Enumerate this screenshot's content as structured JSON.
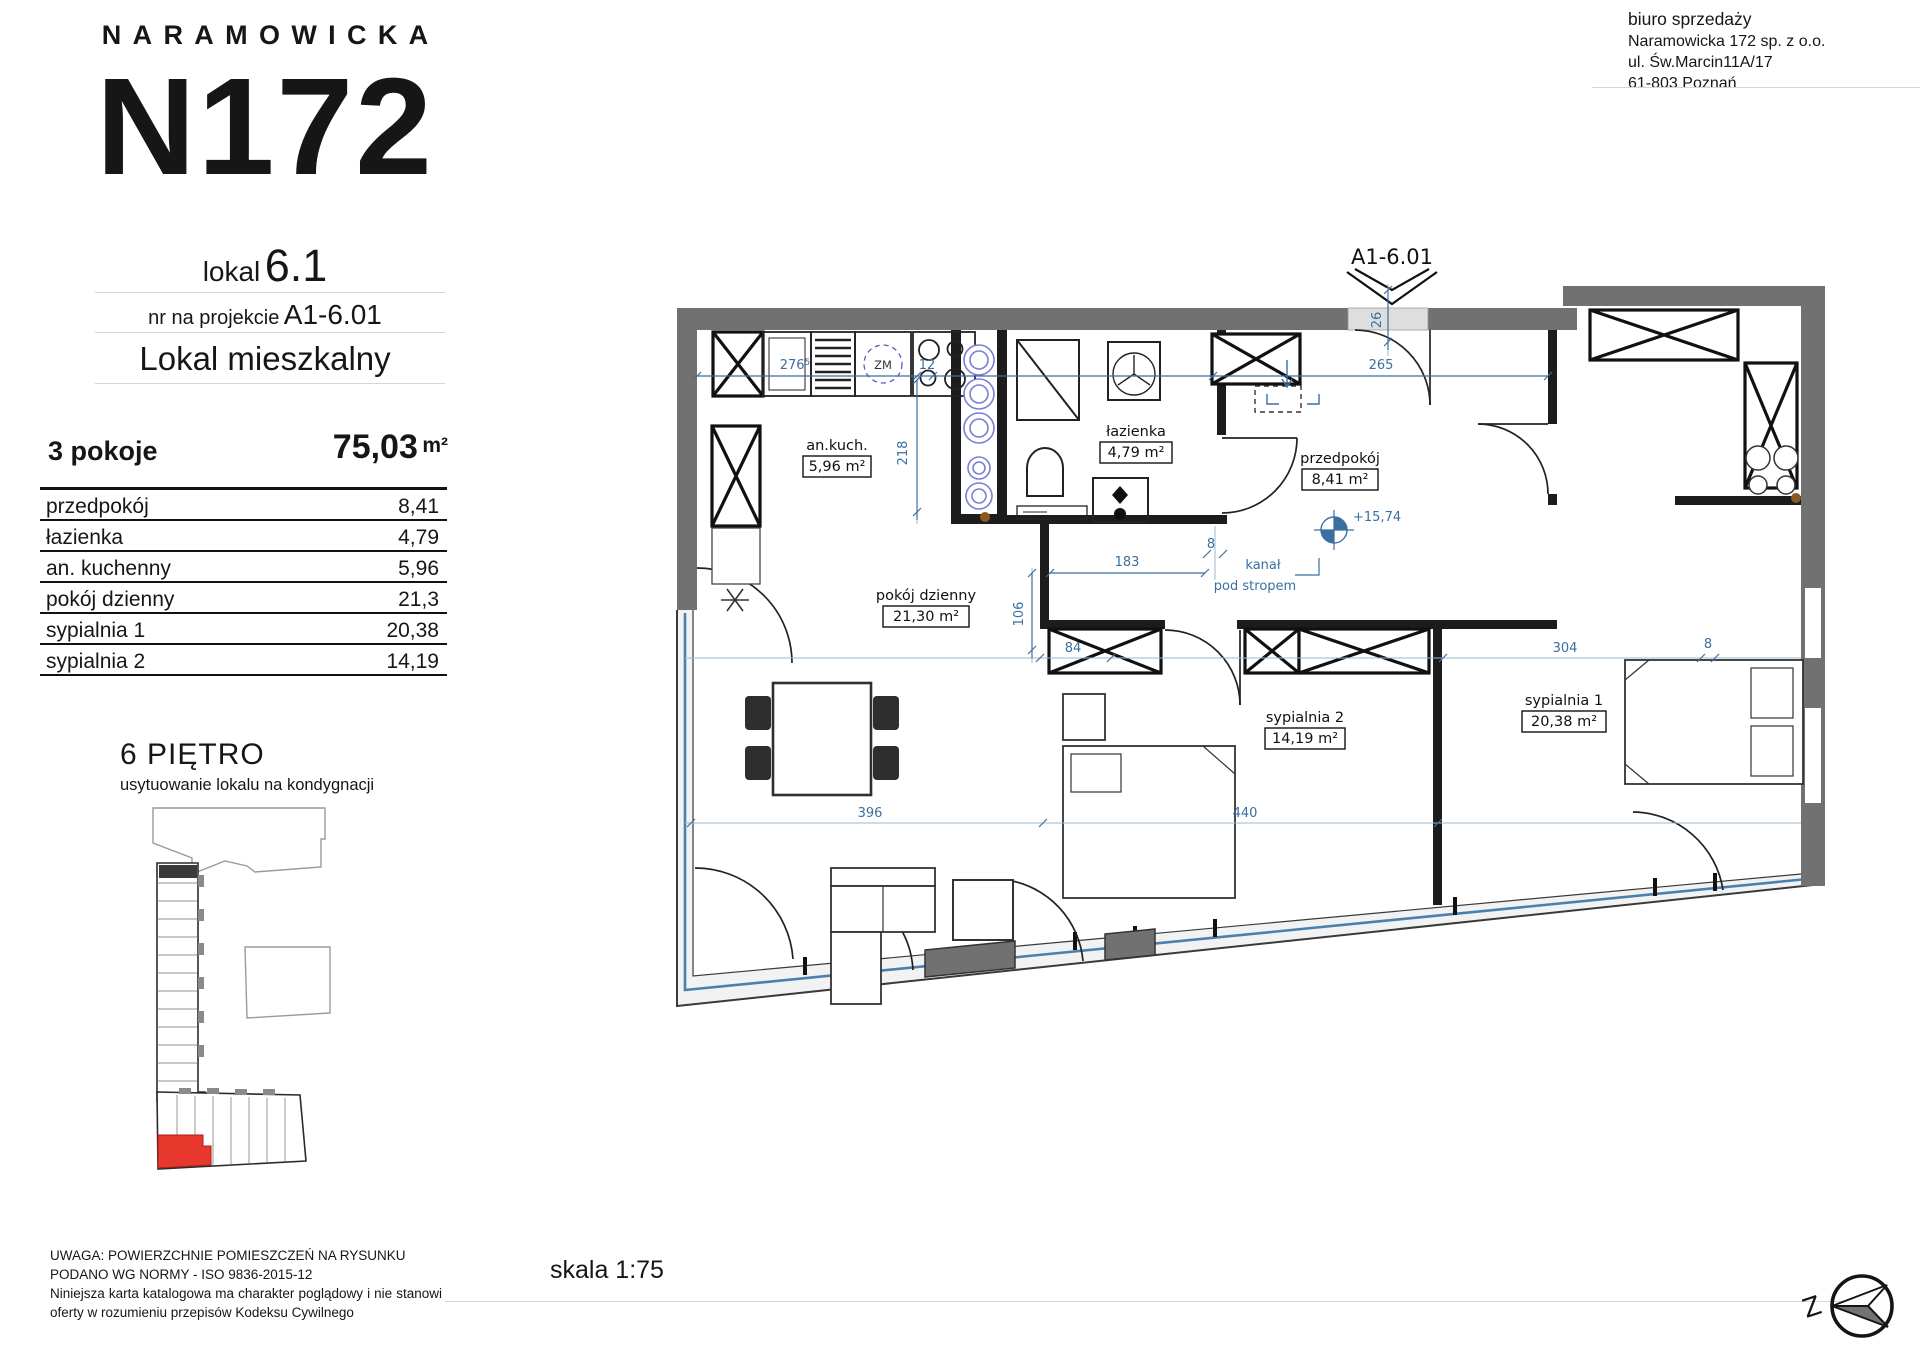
{
  "header": {
    "brand": "NARAMOWICKA",
    "logo": "N172",
    "lokal_label": "lokal",
    "lokal_value": "6.1",
    "project_label": "nr na projekcie",
    "project_value": "A1-6.01",
    "type_label": "Lokal mieszkalny"
  },
  "office": {
    "title": "biuro sprzedaży",
    "line1": "Naramowicka 172 sp. z o.o.",
    "line2": "ul. Św.Marcin11A/17",
    "line3": "61-803 Poznań"
  },
  "summary": {
    "rooms": "3 pokoje",
    "area": "75,03",
    "unit": "m²"
  },
  "room_table": {
    "rows": [
      {
        "label": "przedpokój",
        "value": "8,41"
      },
      {
        "label": "łazienka",
        "value": "4,79"
      },
      {
        "label": "an. kuchenny",
        "value": "5,96"
      },
      {
        "label": "pokój dzienny",
        "value": "21,3"
      },
      {
        "label": "sypialnia 1",
        "value": "20,38"
      },
      {
        "label": "sypialnia 2",
        "value": "14,19"
      }
    ]
  },
  "floor": {
    "title": "6 PIĘTRO",
    "subtitle": "usytuowanie lokalu na kondygnacji"
  },
  "disclaimer": {
    "line1": "UWAGA: POWIERZCHNIE POMIESZCZEŃ NA RYSUNKU",
    "line2": "PODANO WG NORMY - ISO 9836-2015-12",
    "line3": "Niniejsza karta katalogowa ma charakter poglądowy i nie stanowi oferty w rozumieniu przepisów Kodeksu Cywilnego"
  },
  "scale_label": "skala 1:75",
  "compass": {
    "west": "Z"
  },
  "plan": {
    "unit_tag": "A1-6.01",
    "level_mark": "+15,74",
    "duct_line1": "kanał",
    "duct_line2": "pod stropem",
    "appliance_tag": "ZM",
    "rooms": {
      "kitchen": {
        "name": "an.kuch.",
        "area": "5,96 m²"
      },
      "bathroom": {
        "name": "łazienka",
        "area": "4,79 m²"
      },
      "hall": {
        "name": "przedpokój",
        "area": "8,41 m²"
      },
      "living": {
        "name": "pokój dzienny",
        "area": "21,30 m²"
      },
      "bedroom2": {
        "name": "sypialnia 2",
        "area": "14,19 m²"
      },
      "bedroom1": {
        "name": "sypialnia 1",
        "area": "20,38 m²"
      }
    },
    "dims": {
      "d276": "276",
      "d276sup": "5",
      "d12": "12",
      "d218": "218",
      "d265": "265",
      "d26": "26",
      "d8": "8",
      "d183": "183",
      "d106": "106",
      "d84": "84",
      "d304": "304",
      "d396": "396",
      "d440": "440"
    }
  },
  "colors": {
    "dim_blue": "#3c6e9f",
    "wall_gray": "#717171",
    "highlight_red": "#e8372c",
    "glass_blue": "#4a7fae"
  }
}
